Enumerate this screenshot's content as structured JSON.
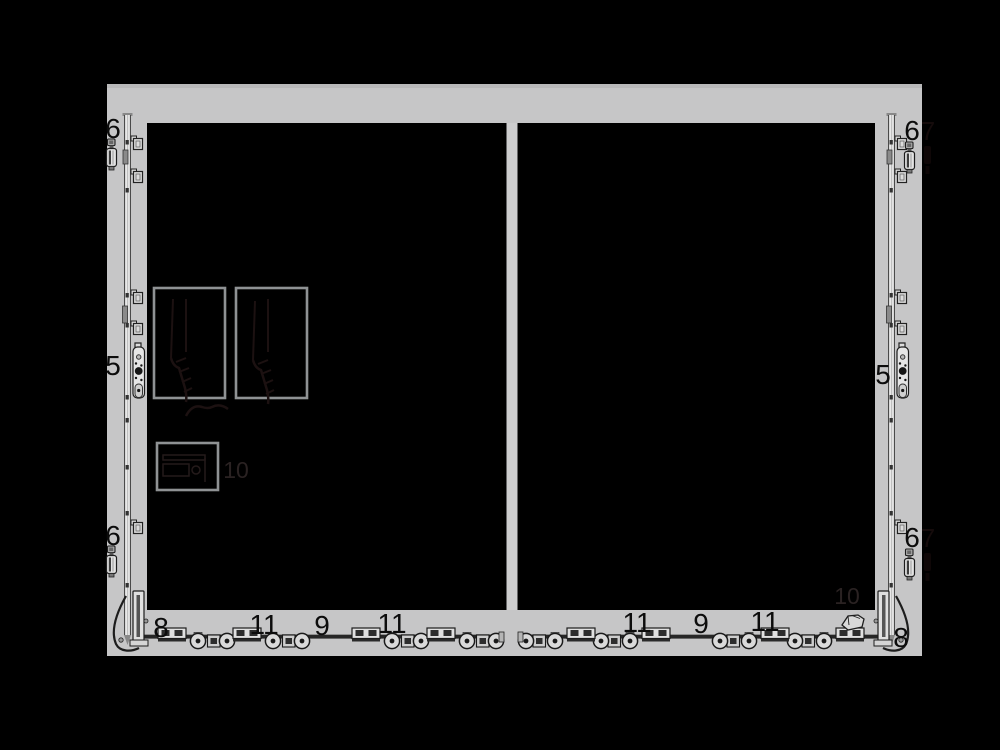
{
  "colors": {
    "background": "#000000",
    "panel": "#c6c6c7",
    "panel_top_edge": "#b9b9ba",
    "divider": "#cdcdce",
    "pane": "#000000",
    "box_border": "#8f9294",
    "metal_light": "#e2e2e2",
    "metal_mid": "#c9c9c9",
    "metal_dark": "#1d1d1d",
    "label": "#0c0c0c",
    "faint_label": "#2a2222",
    "hidden_label": "#150b0b"
  },
  "labels": [
    {
      "part": "six-top-left",
      "text": "6"
    },
    {
      "part": "six-bottom-left",
      "text": "6"
    },
    {
      "part": "five-left",
      "text": "5"
    },
    {
      "part": "six-top-right",
      "text": "6"
    },
    {
      "part": "six-bottom-right",
      "text": "6"
    },
    {
      "part": "five-right",
      "text": "5"
    },
    {
      "part": "eight-left",
      "text": "8"
    },
    {
      "part": "eleven-left-1",
      "text": "11"
    },
    {
      "part": "nine-left",
      "text": "9"
    },
    {
      "part": "eleven-left-2",
      "text": "11"
    },
    {
      "part": "eleven-right-1",
      "text": "11"
    },
    {
      "part": "nine-right",
      "text": "9"
    },
    {
      "part": "eleven-right-2",
      "text": "11"
    },
    {
      "part": "eight-right",
      "text": "8"
    },
    {
      "part": "ten-left",
      "text": "10"
    },
    {
      "part": "ten-right",
      "text": "10"
    },
    {
      "part": "seven-top-right",
      "text": "7"
    },
    {
      "part": "seven-bottom-right",
      "text": "7"
    }
  ]
}
